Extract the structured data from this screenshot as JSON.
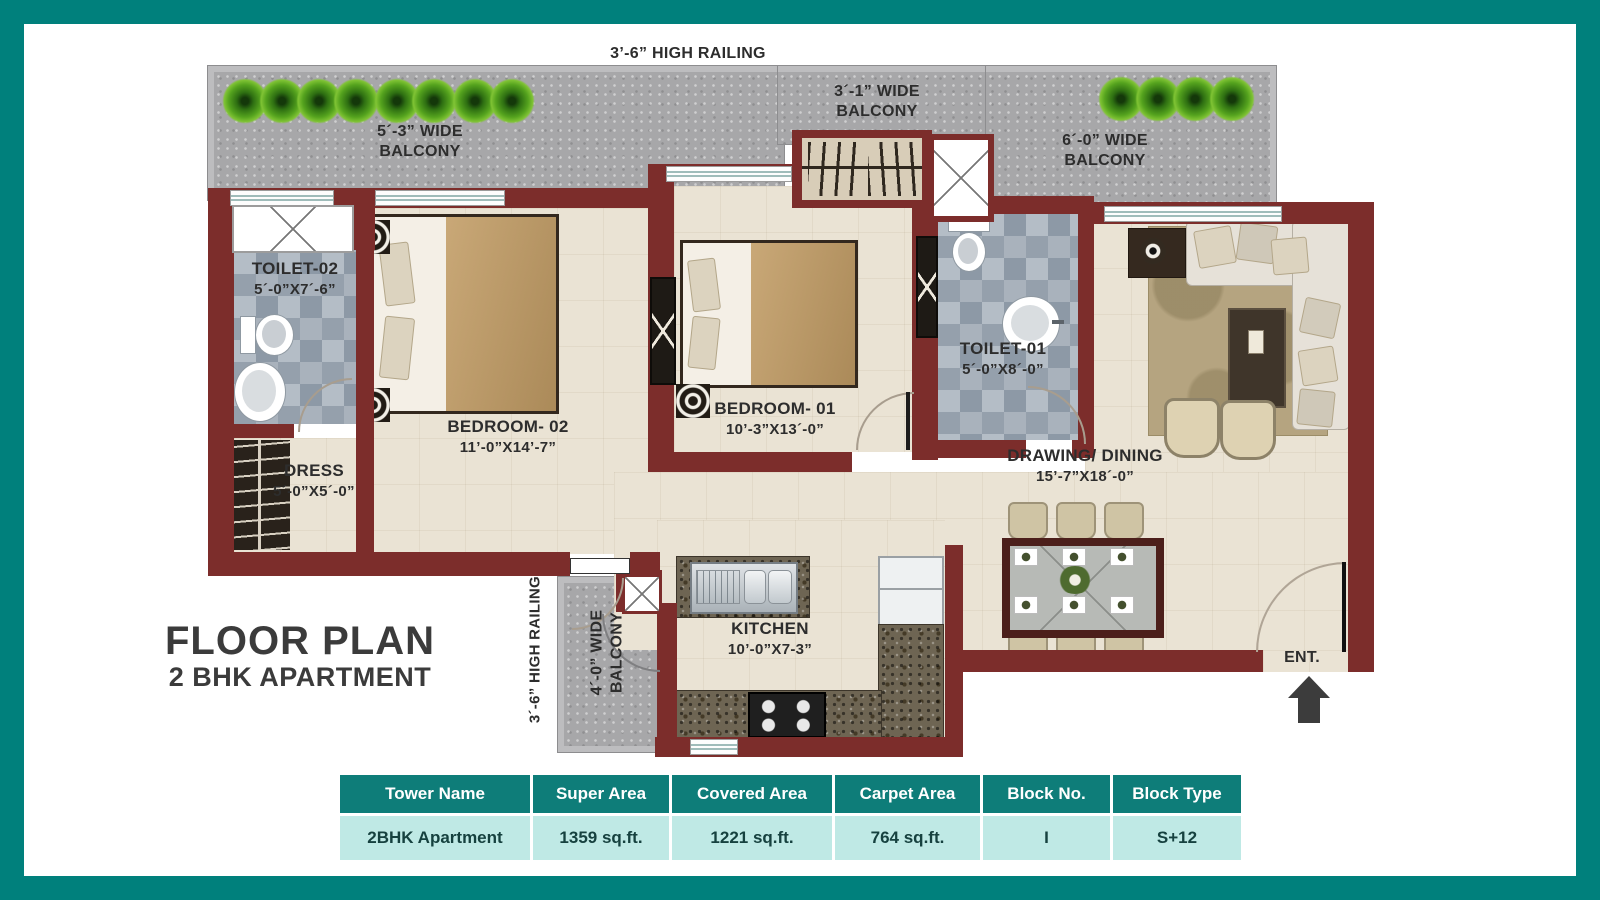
{
  "title": {
    "line1": "FLOOR PLAN",
    "line2": "2 BHK APARTMENT"
  },
  "railings": {
    "top": "3’-6” HIGH RAILING",
    "left": "3´-6” HIGH RAILING"
  },
  "balconies": {
    "top_left": {
      "l1": "5´-3” WIDE",
      "l2": "BALCONY"
    },
    "top_mid": {
      "l1": "3´-1” WIDE",
      "l2": "BALCONY"
    },
    "top_right": {
      "l1": "6´-0” WIDE",
      "l2": "BALCONY"
    },
    "bottom": {
      "l1": "4´-0” WIDE",
      "l2": "BALCONY"
    }
  },
  "rooms": {
    "toilet02": {
      "name": "TOILET-02",
      "dims": "5´-0”X7´-6”"
    },
    "dress": {
      "name": "DRESS",
      "dims": "5´-0”X5´-0”"
    },
    "bedroom02": {
      "name": "BEDROOM- 02",
      "dims": "11’-0”X14’-7”"
    },
    "bedroom01": {
      "name": "BEDROOM- 01",
      "dims": "10’-3”X13´-0”"
    },
    "toilet01": {
      "name": "TOILET-01",
      "dims": "5´-0”X8´-0”"
    },
    "drawing": {
      "name": "DRAWING/ DINING",
      "dims": "15’-7”X18´-0”"
    },
    "kitchen": {
      "name": "KITCHEN",
      "dims": "10’-0”X7-3”"
    }
  },
  "entrance": {
    "label": "ENT."
  },
  "spec_table": {
    "headers": [
      "Tower Name",
      "Super Area",
      "Covered Area",
      "Carpet Area",
      "Block No.",
      "Block Type"
    ],
    "row": [
      "2BHK Apartment",
      "1359 sq.ft.",
      "1221 sq.ft.",
      "764 sq.ft.",
      "I",
      "S+12"
    ]
  },
  "colors": {
    "frame": "#00807c",
    "wall": "#7c2d2b",
    "table_header": "#0e7d79",
    "table_row": "#bfe9e5"
  }
}
